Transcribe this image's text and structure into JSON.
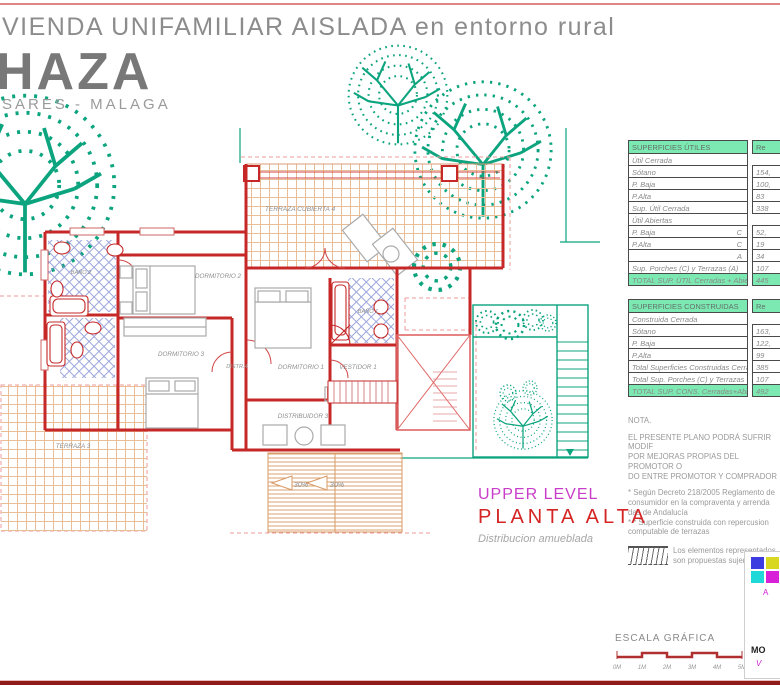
{
  "header": {
    "line1": "VIENDA UNIFAMILIAR AISLADA en entorno rural",
    "line2": "HAZA",
    "line3": "SARES - MALAGA"
  },
  "level": {
    "en": "UPPER LEVEL",
    "es": "PLANTA  ALTA",
    "sub": "Distribucion amueblada"
  },
  "plan": {
    "rooms": {
      "terraza_cubierta": "TERRAZA CUBIERTA 4",
      "dormitorio2": "DORMITORIO 2",
      "dormitorio3": "DORMITORIO 3",
      "distr4": "DISTR.4",
      "dormitorio1": "DORMITORIO 1",
      "vestidor1": "VESTIDOR 1",
      "bano1": "BAÑO 1",
      "bano2": "BAÑO 2",
      "distribuidor3": "DISTRIBUIDOR 3",
      "terraza3": "TERRAZA 3"
    },
    "slopes": [
      "30%",
      "30%"
    ]
  },
  "tables": {
    "utiles": {
      "title": "SUPERFICIES ÚTILES",
      "col": "Re",
      "rows": [
        {
          "label": "Útil Cerrada",
          "value": ""
        },
        {
          "label": "Sótano",
          "value": "154,"
        },
        {
          "label": "P. Baja",
          "value": "100,"
        },
        {
          "label": "P.Alta",
          "value": "83"
        },
        {
          "label": "Sup. Útil Cerrada",
          "value": "338"
        },
        {
          "label": "Útil Abiertas",
          "value": ""
        },
        {
          "label": "P. Baja",
          "tag": "C",
          "value": "52,"
        },
        {
          "label": "P.Alta",
          "tag": "C",
          "value": "19"
        },
        {
          "label": "",
          "tag": "A",
          "value": "34"
        },
        {
          "label": "Sup. Porches (C) y Terrazas (A)",
          "value": "107"
        }
      ],
      "total": {
        "label": "TOTAL SUP. ÚTIL Cerradas + Abiertas",
        "value": "445"
      }
    },
    "construidas": {
      "title": "SUPERFICIES CONSTRUIDAS",
      "col": "Re",
      "rows": [
        {
          "label": "Construida Cerrada",
          "value": ""
        },
        {
          "label": "Sótano",
          "value": "163,"
        },
        {
          "label": "P. Baja",
          "value": "122,"
        },
        {
          "label": "P.Alta",
          "value": "99"
        },
        {
          "label": "Total Superficies Construidas Cerradas",
          "value": "385"
        },
        {
          "label": "Total Sup. Porches (C) y Terrazas (A)",
          "value": "107"
        }
      ],
      "total": {
        "label": "TOTAL SUP. CONS. Cerradas+Abiertas",
        "value": "492"
      }
    }
  },
  "nota": {
    "title": "NOTA.",
    "para1": "EL PRESENTE PLANO PODRÁ SUFRIR MODIF\nPOR MEJORAS PROPIAS DEL PROMOTOR O\nDO ENTRE PROMOTOR Y COMPRADOR",
    "para2": "* Según Decreto 218/2005 Reglamento de\nconsumidor en la compraventa y arrenda\ndas de Andalucía\n* * Superficie construida con repercusion\ncomputable de terrazas",
    "legend": "Los elementos representados\nson propuestas sujeridas."
  },
  "escala": {
    "label": "ESCALA GRÁFICA",
    "ticks": [
      "0M",
      "1M",
      "2M",
      "3M",
      "4M",
      "5M"
    ]
  },
  "logo": {
    "fragments": {
      "a": "A",
      "mo": "MO",
      "v": "V"
    }
  },
  "colors": {
    "wall_red": "#c62828",
    "terrace_orange": "#e2a577",
    "tile_blue": "#7b88cf",
    "tree_teal": "#0ca47e",
    "table_green": "#7ce9b2",
    "magenta": "#c93ec9",
    "title_red": "#d42424",
    "slope_cyan": "#25b6c9"
  }
}
